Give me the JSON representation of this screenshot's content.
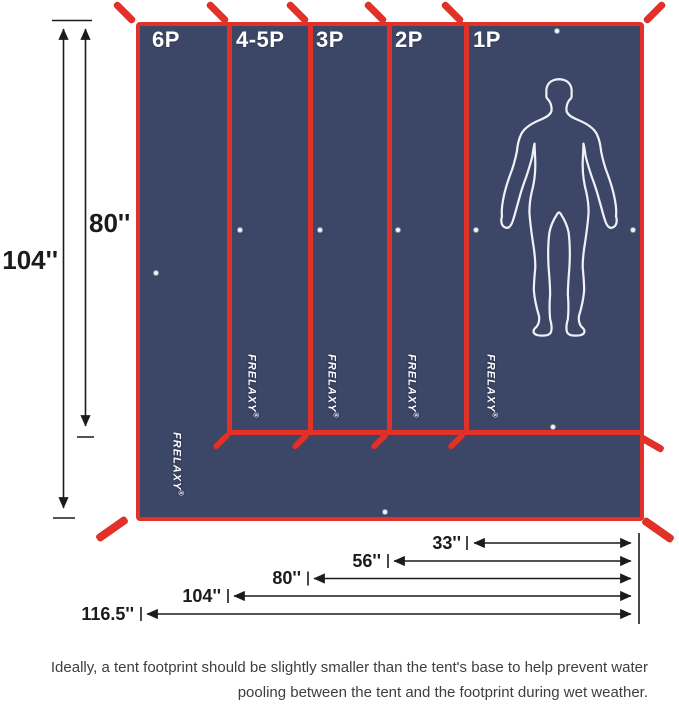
{
  "product": {
    "brand": "FRELAXY",
    "registered_mark": "®"
  },
  "panels": [
    {
      "label": "6P"
    },
    {
      "label": "4-5P"
    },
    {
      "label": "3P"
    },
    {
      "label": "2P"
    },
    {
      "label": "1P"
    }
  ],
  "dimensions": {
    "left": [
      {
        "label": "104''"
      },
      {
        "label": "80''"
      }
    ],
    "bottom": [
      {
        "label": "33''"
      },
      {
        "label": "56''"
      },
      {
        "label": "80''"
      },
      {
        "label": "104''"
      },
      {
        "label": "116.5''"
      }
    ]
  },
  "caption": {
    "line1": "Ideally, a tent footprint should be slightly smaller than the tent's base to help prevent water",
    "line2": "pooling between the tent and the footprint during wet weather."
  },
  "colors": {
    "fabric_navy": "#3c4666",
    "trim_red": "#e23128",
    "dimension_text": "#1b1b1b",
    "caption_text": "#3e3e3e"
  },
  "icons": {
    "silhouette": "human-silhouette-icon",
    "grommet": "grommet-icon",
    "strap": "tie-strap-icon"
  }
}
